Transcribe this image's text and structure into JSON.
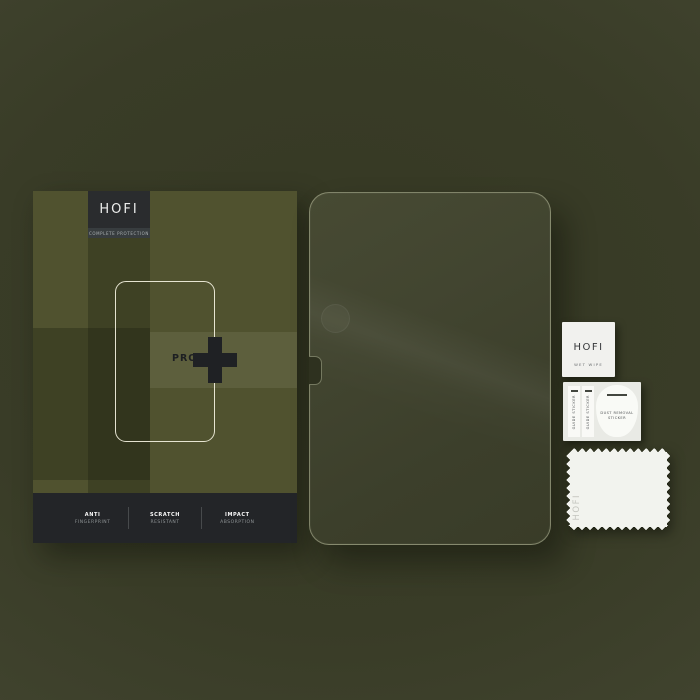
{
  "scene": {
    "description": "HOFI Glass Pro+ tempered glass screen protector set on olive background"
  },
  "colors": {
    "background_olive": "#393c27",
    "box_olive": "#50522f",
    "logo_square_charcoal": "#2a2c2e",
    "features_bar_charcoal": "#232528",
    "glass_tint": "#41442e",
    "outline_cream": "#f3f1e0",
    "white_item": "#f1f1ee",
    "plus_dark": "#1f2124"
  },
  "box": {
    "brand": "HOFI",
    "tagline": "COMPLETE PROTECTION",
    "model": "PRO",
    "plus_symbol": "+",
    "features": [
      {
        "line1": "ANTI",
        "line2": "FINGERPRINT"
      },
      {
        "line1": "SCRATCH",
        "line2": "RESISTANT"
      },
      {
        "line1": "IMPACT",
        "line2": "ABSORPTION"
      }
    ]
  },
  "accessories": {
    "wet_wipe": {
      "brand": "HOFI",
      "label": "WET WIPE"
    },
    "sticker_sheet": {
      "guide_sticker_1": "GUIDE STICKER",
      "guide_sticker_2": "GUIDE STICKER",
      "dust_removal_line1": "DUST REMOVAL",
      "dust_removal_line2": "STICKER"
    },
    "cloth": {
      "brand": "HOFI"
    }
  }
}
